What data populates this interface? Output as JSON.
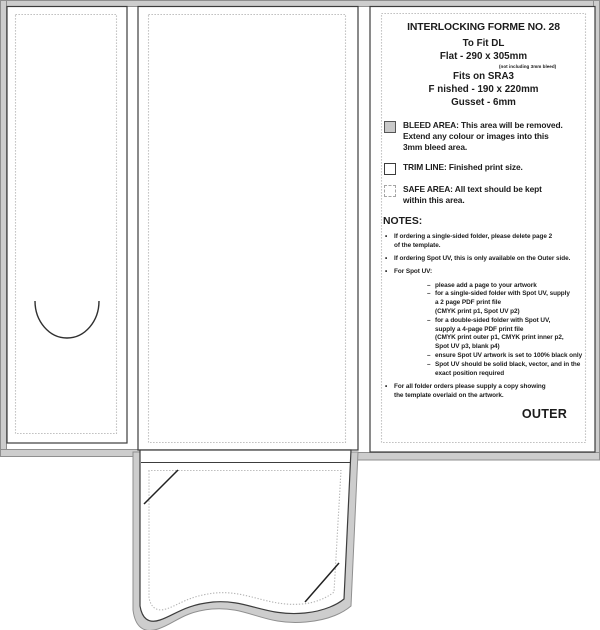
{
  "colors": {
    "bleed_fill": "#cdcdcd",
    "bleed_edge": "#8f8f8f",
    "trim_line": "#3c3c3c",
    "safe_line": "#b3b3b3",
    "text": "#1c1c1c"
  },
  "markers": {
    "bullet": "•",
    "dash": "–"
  },
  "panel": {
    "header": {
      "title": "INTERLOCKING FORME NO. 28",
      "fit": "To Fit DL",
      "flat": "Flat - 290 x 305mm",
      "flat_note": "(not including 3mm bleed)",
      "fits_on": "Fits on SRA3",
      "finished": "F nished - 190 x 220mm",
      "gusset": "Gusset - 6mm"
    },
    "legend": [
      {
        "swatch": "filled",
        "lines": [
          "BLEED AREA: This area will be removed.",
          "Extend any colour or images into this",
          "3mm bleed area."
        ]
      },
      {
        "swatch": "solid",
        "lines": [
          "TRIM LINE: Finished print size."
        ]
      },
      {
        "swatch": "dashed",
        "lines": [
          "SAFE AREA: All text should be kept",
          "within this area."
        ]
      }
    ],
    "notes": {
      "heading": "NOTES:",
      "bullet1": [
        "If ordering a single-sided folder, please delete page 2",
        "of the template."
      ],
      "bullet2": [
        "If ordering Spot UV, this is only available on the Outer side."
      ],
      "bullet3_head": "For Spot UV:",
      "sub1": [
        "please add a page to your artwork"
      ],
      "sub2": [
        "for a single-sided folder with Spot UV, supply",
        "a 2 page PDF print file",
        "(CMYK print p1, Spot UV p2)"
      ],
      "sub3": [
        "for a double-sided folder with Spot UV,",
        "supply a 4-page PDF print file",
        "(CMYK print outer p1, CMYK print inner p2,",
        "Spot UV p3, blank p4)"
      ],
      "sub4": [
        "ensure Spot UV artwork is set to 100% black only"
      ],
      "sub5": [
        "Spot UV should be solid black, vector, and in the",
        "exact position required"
      ],
      "bullet4": [
        "For all folder orders please supply a copy showing",
        "the template overlaid on the artwork."
      ]
    },
    "outer_label": "OUTER"
  }
}
